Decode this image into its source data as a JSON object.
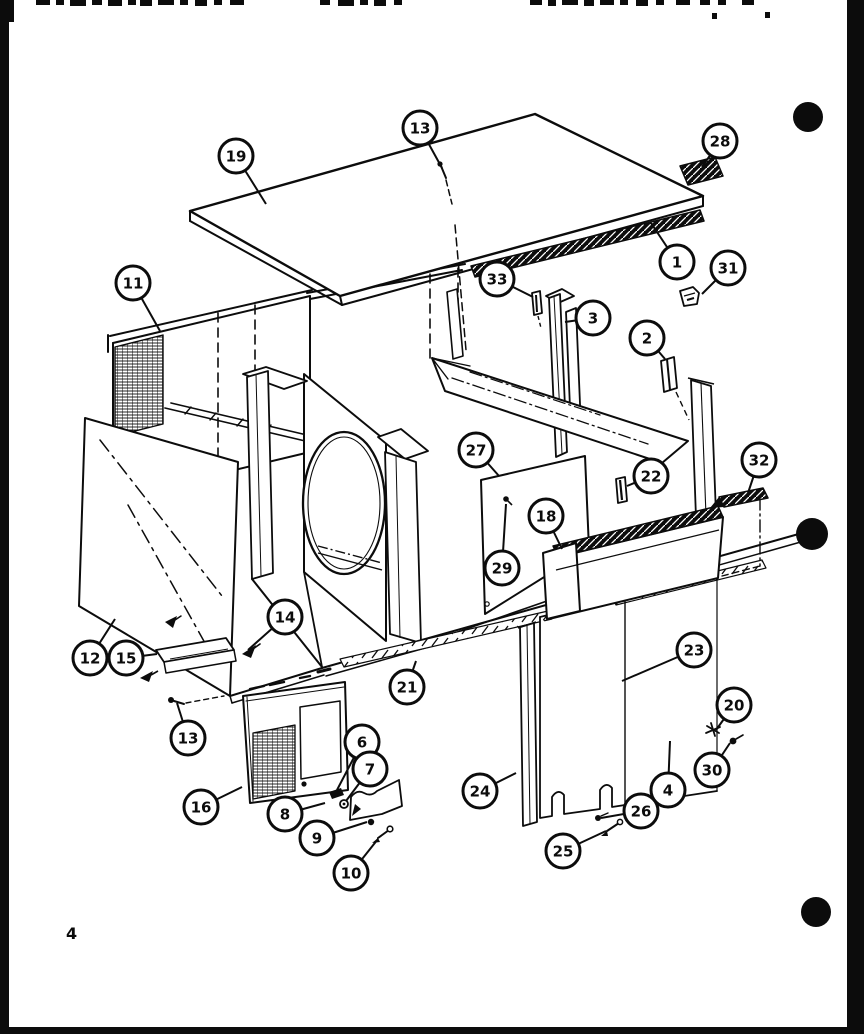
{
  "page": {
    "number": "4",
    "ink": "#0c0c0c",
    "paper": "#ffffff",
    "binder_dots": [
      {
        "x": 808,
        "y": 117,
        "r": 15
      },
      {
        "x": 812,
        "y": 534,
        "r": 16
      },
      {
        "x": 816,
        "y": 912,
        "r": 15
      }
    ]
  },
  "diagram": {
    "type": "exploded-parts-view",
    "description": "Exploded view of appliance cabinet panels with numbered callouts",
    "callouts": [
      {
        "label": "19",
        "x": 236,
        "y": 156,
        "tx": 266,
        "ty": 204
      },
      {
        "label": "13",
        "x": 420,
        "y": 128,
        "tx": 442,
        "ty": 168
      },
      {
        "label": "28",
        "x": 720,
        "y": 141,
        "tx": 702,
        "ty": 167
      },
      {
        "label": "1",
        "x": 677,
        "y": 262,
        "tx": 651,
        "ty": 223
      },
      {
        "label": "31",
        "x": 728,
        "y": 268,
        "tx": 702,
        "ty": 294
      },
      {
        "label": "11",
        "x": 133,
        "y": 283,
        "tx": 160,
        "ty": 331
      },
      {
        "label": "33",
        "x": 497,
        "y": 279,
        "tx": 533,
        "ty": 297
      },
      {
        "label": "3",
        "x": 593,
        "y": 318,
        "tx": 565,
        "ty": 322
      },
      {
        "label": "2",
        "x": 647,
        "y": 338,
        "tx": 665,
        "ty": 359
      },
      {
        "label": "27",
        "x": 476,
        "y": 450,
        "tx": 499,
        "ty": 476
      },
      {
        "label": "22",
        "x": 651,
        "y": 476,
        "tx": 627,
        "ty": 486
      },
      {
        "label": "32",
        "x": 759,
        "y": 460,
        "tx": 748,
        "ty": 493
      },
      {
        "label": "18",
        "x": 546,
        "y": 516,
        "tx": 562,
        "ty": 549
      },
      {
        "label": "29",
        "x": 502,
        "y": 568,
        "tx": 506,
        "ty": 504
      },
      {
        "label": "12",
        "x": 90,
        "y": 658,
        "tx": 115,
        "ty": 619
      },
      {
        "label": "15",
        "x": 126,
        "y": 658,
        "tx": 157,
        "ty": 654
      },
      {
        "label": "14",
        "x": 285,
        "y": 617,
        "tx": 248,
        "ty": 650
      },
      {
        "label": "21",
        "x": 407,
        "y": 687,
        "tx": 416,
        "ty": 661
      },
      {
        "label": "23",
        "x": 694,
        "y": 650,
        "tx": 622,
        "ty": 681
      },
      {
        "label": "13",
        "x": 188,
        "y": 738,
        "tx": 177,
        "ty": 703
      },
      {
        "label": "20",
        "x": 734,
        "y": 705,
        "tx": 716,
        "ty": 730
      },
      {
        "label": "30",
        "x": 712,
        "y": 770,
        "tx": 730,
        "ty": 743
      },
      {
        "label": "4",
        "x": 668,
        "y": 790,
        "tx": 670,
        "ty": 741
      },
      {
        "label": "16",
        "x": 201,
        "y": 807,
        "tx": 242,
        "ty": 787
      },
      {
        "label": "6",
        "x": 362,
        "y": 742,
        "tx": 337,
        "ty": 790
      },
      {
        "label": "7",
        "x": 370,
        "y": 769,
        "tx": 346,
        "ty": 801
      },
      {
        "label": "8",
        "x": 285,
        "y": 814,
        "tx": 325,
        "ty": 803
      },
      {
        "label": "9",
        "x": 317,
        "y": 838,
        "tx": 367,
        "ty": 822
      },
      {
        "label": "10",
        "x": 351,
        "y": 873,
        "tx": 378,
        "ty": 839
      },
      {
        "label": "24",
        "x": 480,
        "y": 791,
        "tx": 516,
        "ty": 773
      },
      {
        "label": "26",
        "x": 641,
        "y": 811,
        "tx": 601,
        "ty": 818
      },
      {
        "label": "25",
        "x": 563,
        "y": 851,
        "tx": 606,
        "ty": 831
      }
    ]
  }
}
